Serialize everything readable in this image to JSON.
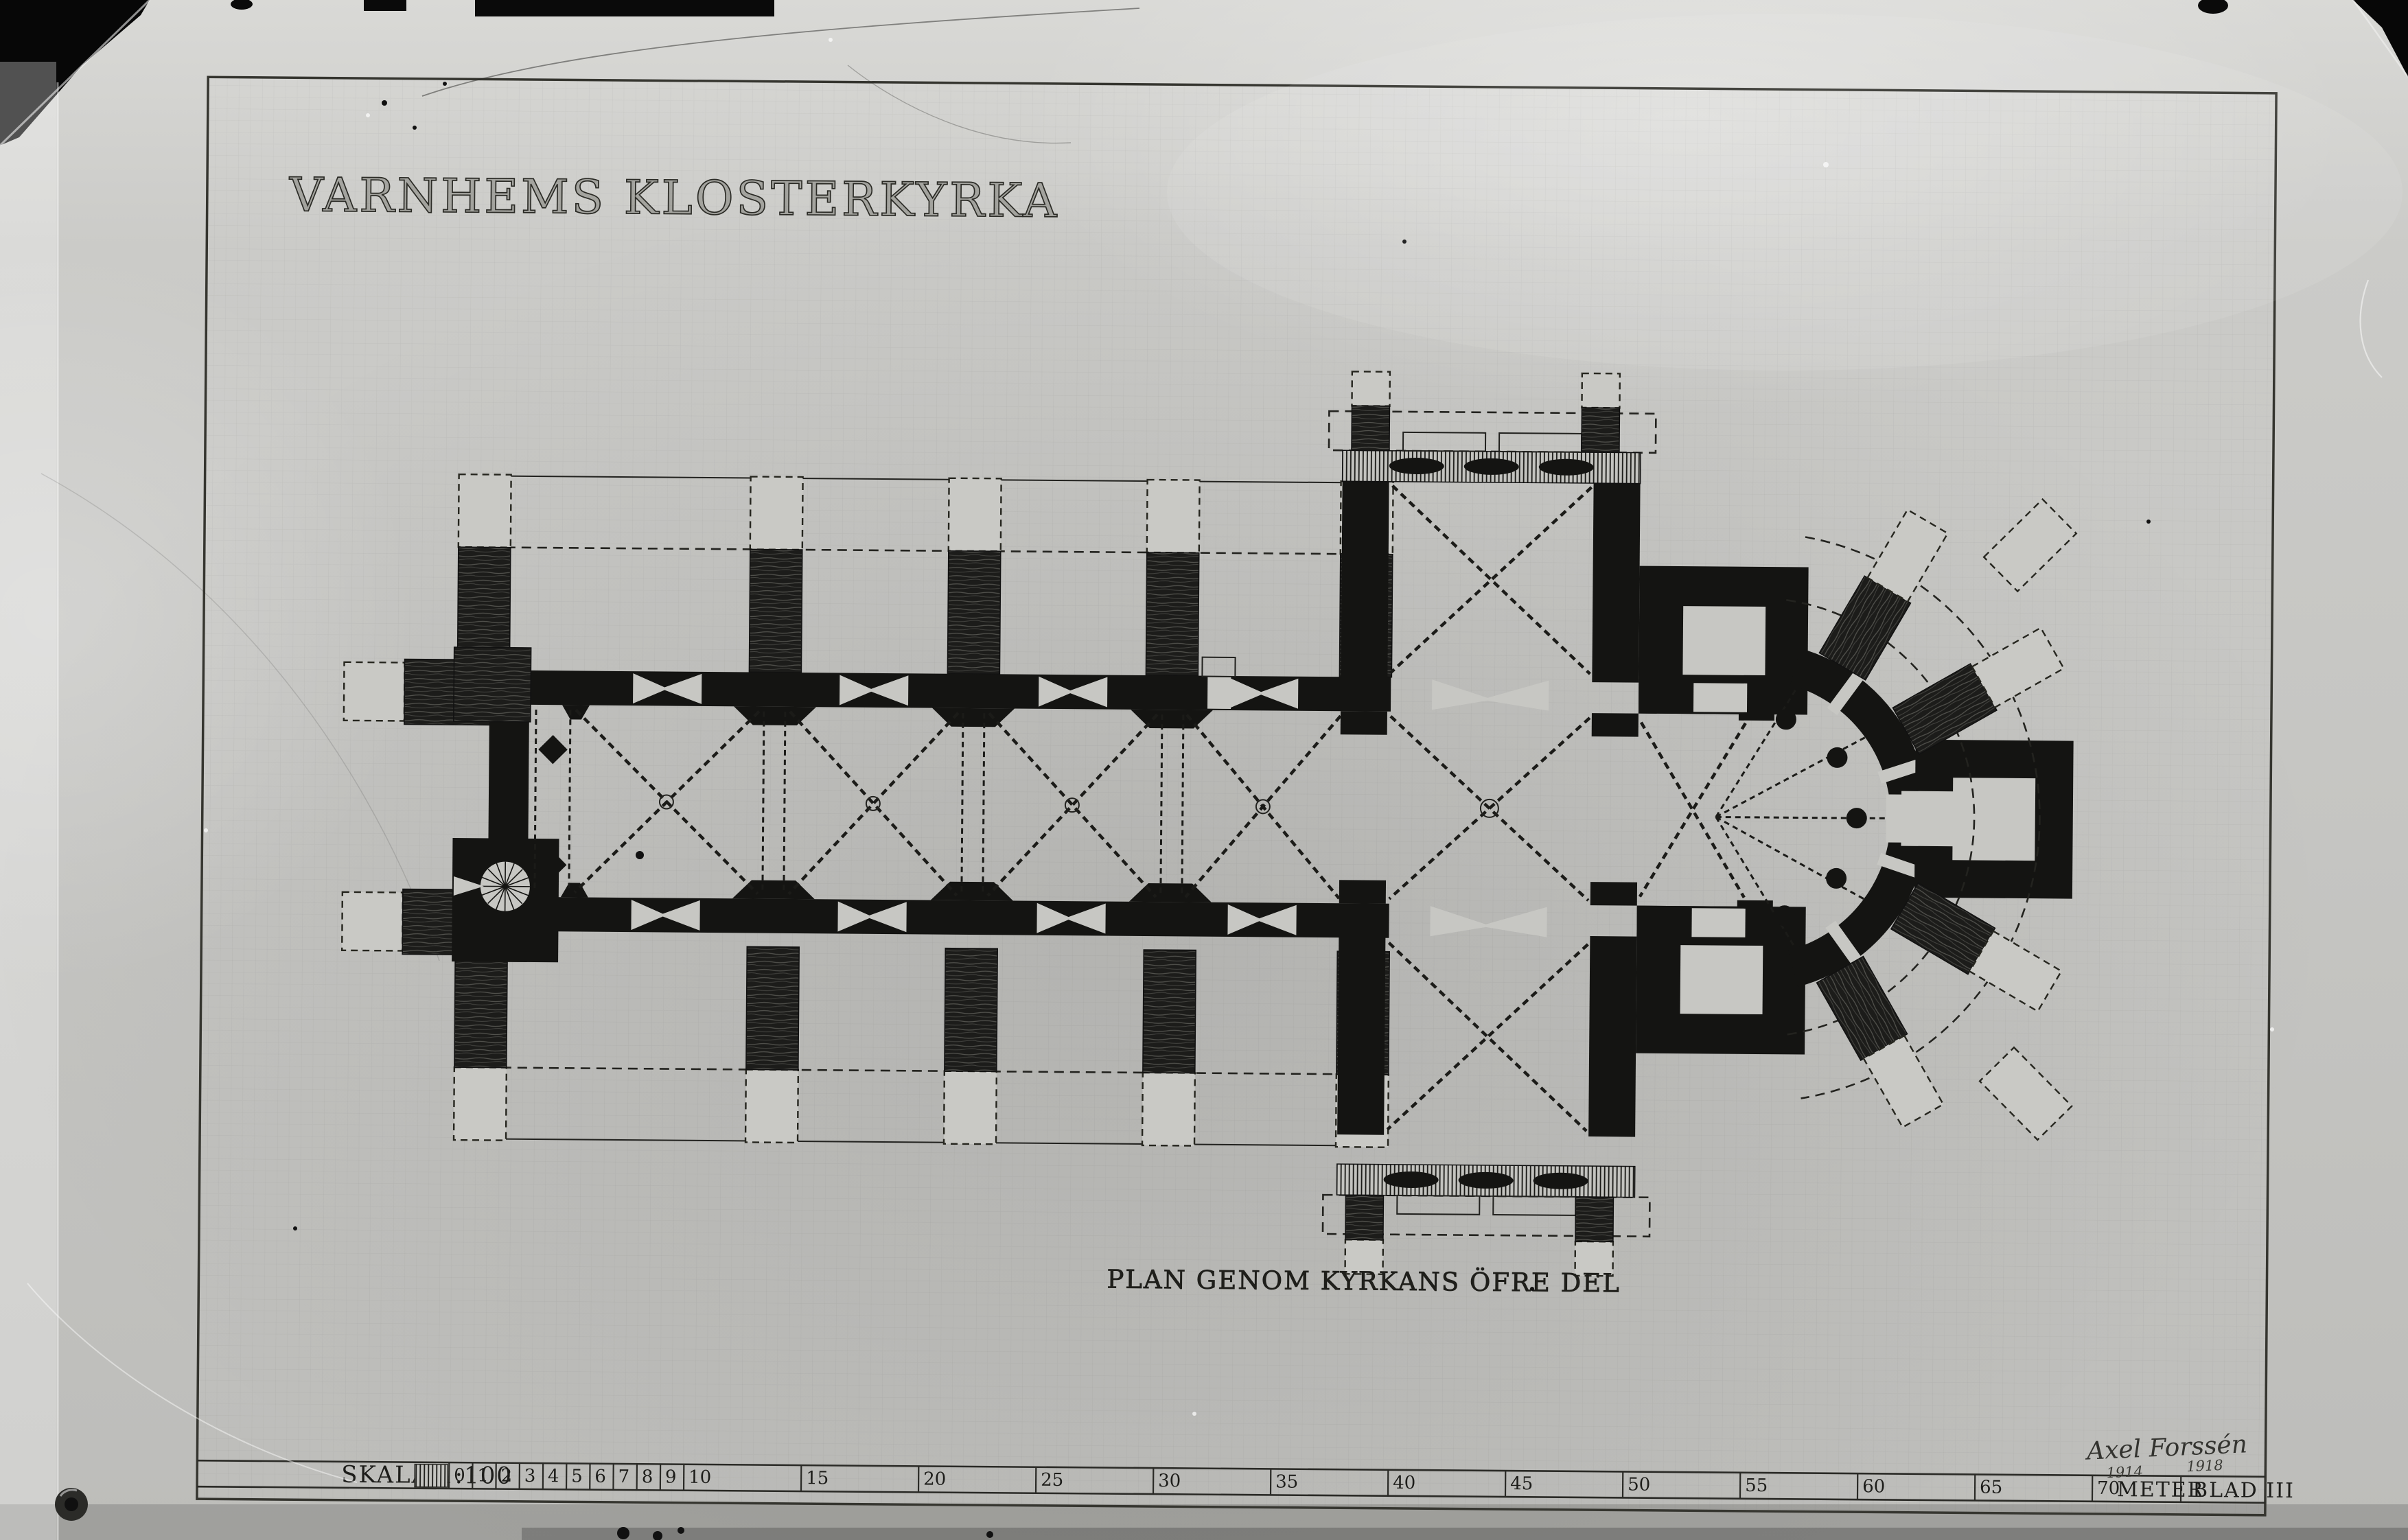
{
  "texts": {
    "title": "VARNHEMS KLOSTERKYRKA",
    "caption": "PLAN GENOM KYRKANS ÖFRE DEL",
    "scale_label": "SKALA 1:100",
    "unit_label": "METER",
    "sheet_number": "BLAD III",
    "signature_name": "Axel Forssén",
    "signature_year_left": "1914",
    "signature_year_right": "1918"
  },
  "scale_bar": {
    "meter_marks": [
      0,
      1,
      2,
      3,
      4,
      5,
      6,
      7,
      8,
      9,
      10,
      15,
      20,
      25,
      30,
      35,
      40,
      45,
      50,
      55,
      60,
      65,
      70
    ]
  },
  "colors": {
    "ink": "#141412",
    "paper": "#c7c7c3",
    "plate_edge": "#070707",
    "photo_shadow": "#8c8c89"
  }
}
